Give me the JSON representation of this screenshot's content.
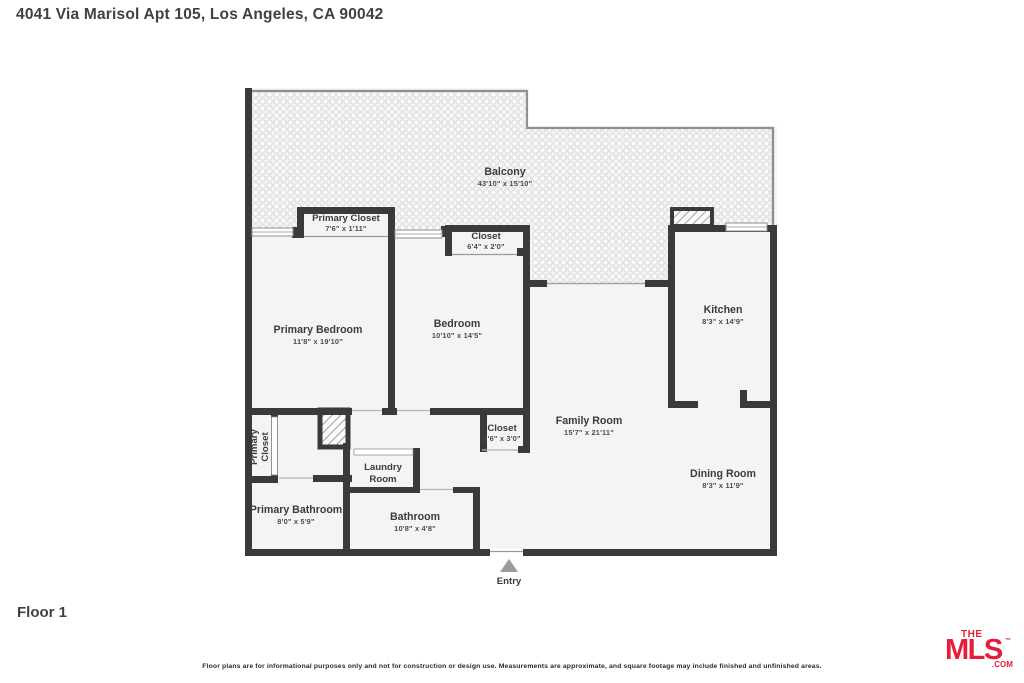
{
  "page": {
    "title": "4041 Via Marisol Apt 105, Los Angeles, CA 90042",
    "floor_label": "Floor 1",
    "disclaimer": "Floor plans are for informational purposes only and not for construction or design use. Measurements are approximate, and square footage may include finished and unfinished areas."
  },
  "logo": {
    "the": "THE",
    "mls": "MLS",
    "tm": "™",
    "com": ".COM",
    "color": "#e41e3a"
  },
  "floor_plan": {
    "wall_color": "#3a3a3a",
    "room_fill": "#f4f4f4",
    "balcony_texture": "dot-pattern",
    "entry": {
      "label": "Entry",
      "arrow_icon": "up-triangle"
    },
    "rooms": [
      {
        "name": "Balcony",
        "dims": "43'10\" x 15'10\""
      },
      {
        "name": "Primary Closet",
        "dims": "7'6\" x 1'11\""
      },
      {
        "name": "Closet",
        "dims": "6'4\" x 2'0\""
      },
      {
        "name": "Primary Bedroom",
        "dims": "11'8\" x 19'10\""
      },
      {
        "name": "Bedroom",
        "dims": "10'10\" x 14'5\""
      },
      {
        "name": "Kitchen",
        "dims": "8'3\" x 14'9\""
      },
      {
        "name": "Family Room",
        "dims": "15'7\" x 21'11\""
      },
      {
        "name": "Closet",
        "dims": "3'6\" x 3'0\""
      },
      {
        "name": "Primary Closet",
        "dims": "",
        "line1": "Primary",
        "line2": "Closet"
      },
      {
        "name": "Laundry Room",
        "dims": "",
        "line1": "Laundry",
        "line2": "Room"
      },
      {
        "name": "Primary Bathroom",
        "dims": "8'0\" x 5'9\""
      },
      {
        "name": "Bathroom",
        "dims": "10'8\" x 4'8\""
      },
      {
        "name": "Dining Room",
        "dims": "8'3\" x 11'9\""
      }
    ]
  }
}
